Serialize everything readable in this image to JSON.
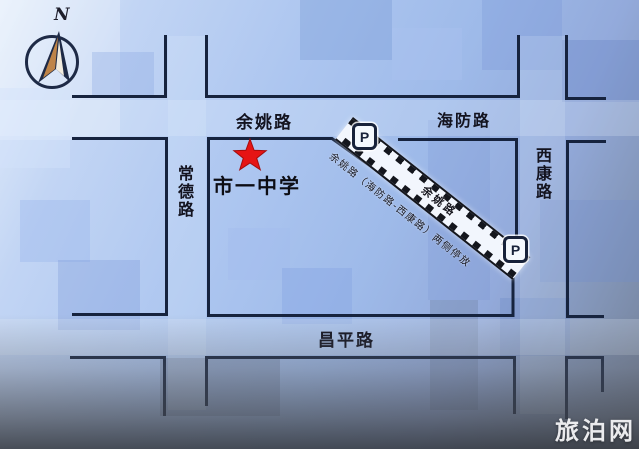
{
  "compass": {
    "label": "N"
  },
  "roads": {
    "yuyao": "余姚路",
    "haifang": "海防路",
    "changde": "常德路",
    "xikang": "西康路",
    "changping": "昌平路"
  },
  "school": {
    "name": "市一中学"
  },
  "parking": {
    "strip_label": "余姚路（海防路-西康路）两侧停放",
    "road_name": "余姚路",
    "p_icon": "P"
  },
  "watermark": {
    "text": "旅泊网"
  },
  "colors": {
    "road_line": "#16233e",
    "star_red": "#e61414",
    "background_blue": "#a9c3ef",
    "strip_white": "#f2f6fd",
    "compass_tan": "#bf8448"
  }
}
